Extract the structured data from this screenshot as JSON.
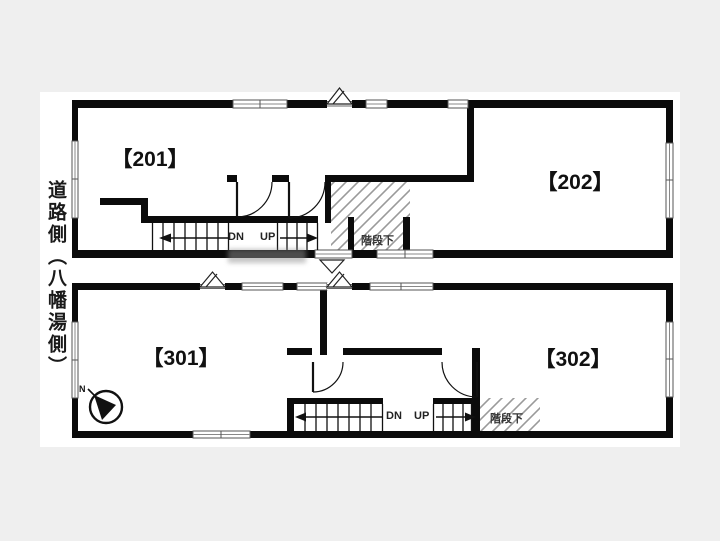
{
  "side_label": "道路側（八幡湯側）",
  "compass": {
    "direction": "N"
  },
  "floors": {
    "upper": {
      "room_left": "【201】",
      "room_right": "【202】",
      "down_label": "DN",
      "up_label": "UP",
      "under_stairs_label": "階段下"
    },
    "lower": {
      "room_left": "【301】",
      "room_right": "【302】",
      "down_label": "DN",
      "up_label": "UP",
      "under_stairs_label": "階段下"
    }
  },
  "colors": {
    "background": "#efefef",
    "paper": "#ffffff",
    "wall": "#0b0b0b",
    "hatch": "#9a9a9a"
  }
}
